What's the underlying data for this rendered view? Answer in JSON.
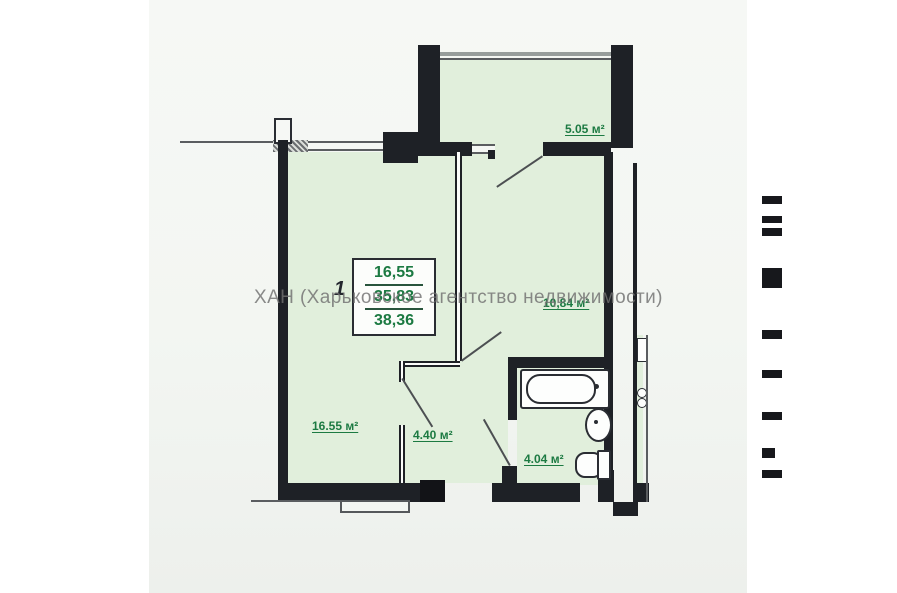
{
  "watermark": "ХАН (Харьковское агентство недвижимости)",
  "stamp": {
    "rooms_count": "1",
    "living_area": "16,55",
    "area_without_summer": "35,83",
    "total_area": "38,36"
  },
  "labels": {
    "balcony": "5.05 м²",
    "kitchen": "10,84 м²",
    "living_room": "16.55 м²",
    "hallway": "4.40 м²",
    "bathroom": "4.04 м²"
  }
}
